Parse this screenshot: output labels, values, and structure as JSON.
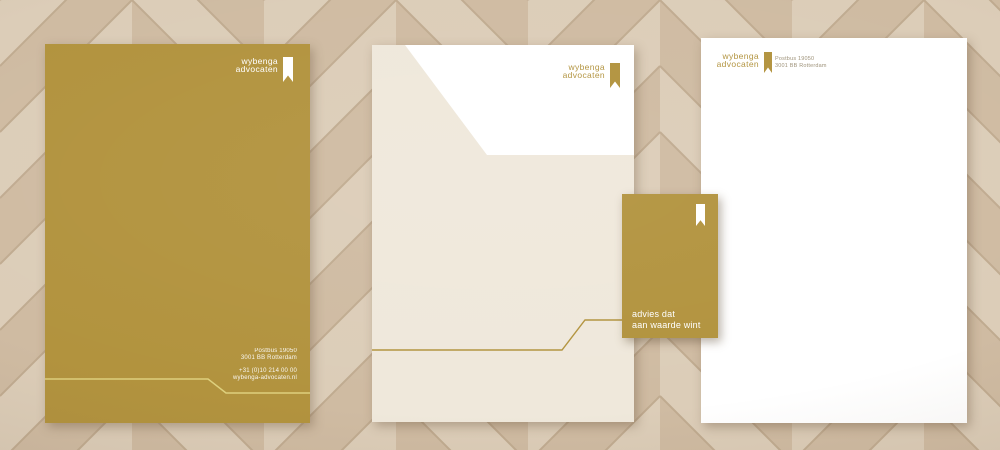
{
  "colors": {
    "brand_gold": "#b2933e",
    "cream": "#efe8db",
    "paper_white": "#ffffff",
    "pale_line": "#ded07d",
    "address_gray": "#9d9178",
    "wood_light": "#d6c4ac",
    "wood_seam": "#c0ab90"
  },
  "brand": {
    "logo_line1": "wybenga",
    "logo_line2": "advocaten",
    "logo_icon": "bookmark-ribbon"
  },
  "left_folder": {
    "contact": {
      "po_box": "Postbus 19050",
      "postal_city": "3001 BB Rotterdam",
      "phone": "+31 (0)10 214 00 00",
      "website": "wybenga-advocaten.nl"
    }
  },
  "notecard": {
    "tagline_line1": "advies dat",
    "tagline_line2": "aan waarde wint"
  },
  "letterhead": {
    "address_line1": "Postbus 19050",
    "address_line2": "3001 BB Rotterdam"
  }
}
